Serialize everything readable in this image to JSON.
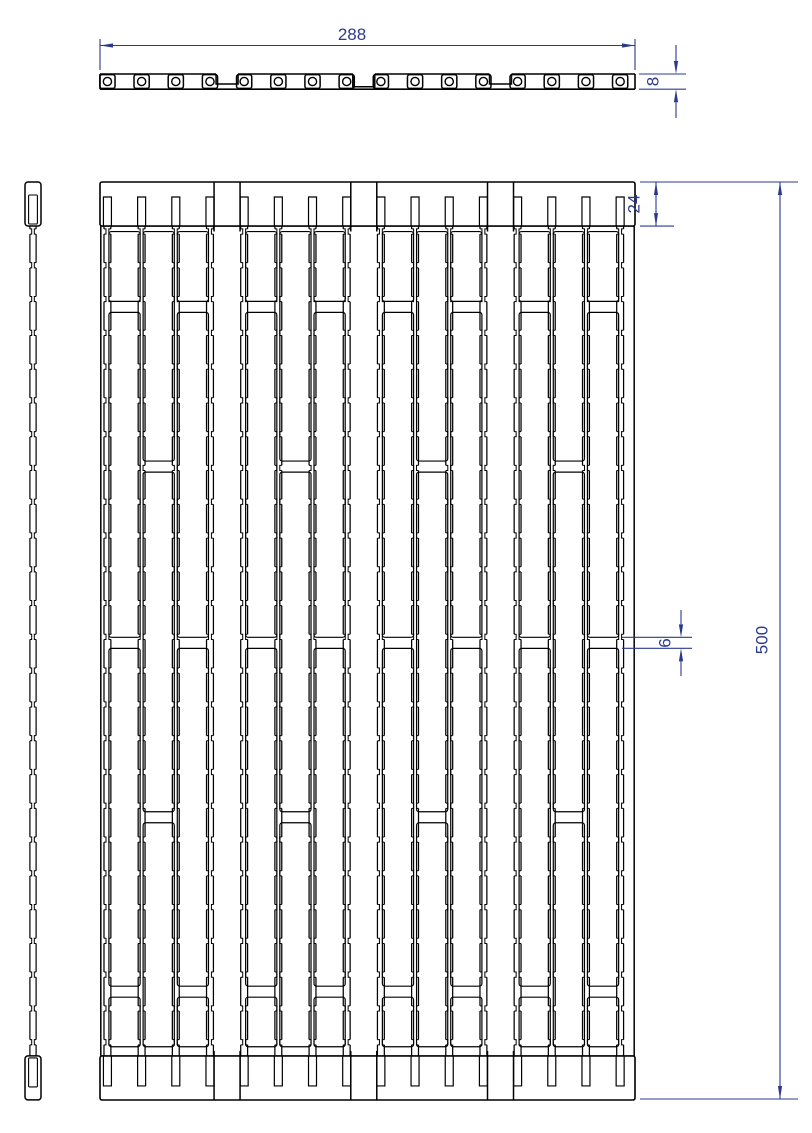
{
  "drawing": {
    "type": "technical-drawing",
    "colors": {
      "line": "#000000",
      "dimension": "#2b3a8f",
      "background": "#ffffff"
    },
    "dimensions": {
      "overall_width": {
        "value": "288"
      },
      "plate_thickness": {
        "value": "8"
      },
      "end_rail_height": {
        "value": "24"
      },
      "bridge_gap": {
        "value": "6"
      },
      "overall_height": {
        "value": "500"
      }
    },
    "structure": {
      "strip_count": 16,
      "panel_count": 4,
      "strips_per_panel": 4,
      "hole_count": 16,
      "notch_row_count": 25,
      "units": {
        "width": 288,
        "height": 500,
        "end_rail": 24,
        "thickness": 8,
        "bridge": 6,
        "strip_pitch": 18.4,
        "strip_first_center": 4,
        "strip_width": 3.6,
        "notch_pitch": 18.4
      },
      "a_gap_slot_segments_units": [
        [
          27,
          65
        ],
        [
          71,
          248
        ],
        [
          254,
          438
        ],
        [
          444,
          471
        ]
      ],
      "b_gap_slot_segments_units": [
        [
          27,
          152
        ],
        [
          158,
          343
        ],
        [
          349,
          471
        ]
      ]
    }
  }
}
